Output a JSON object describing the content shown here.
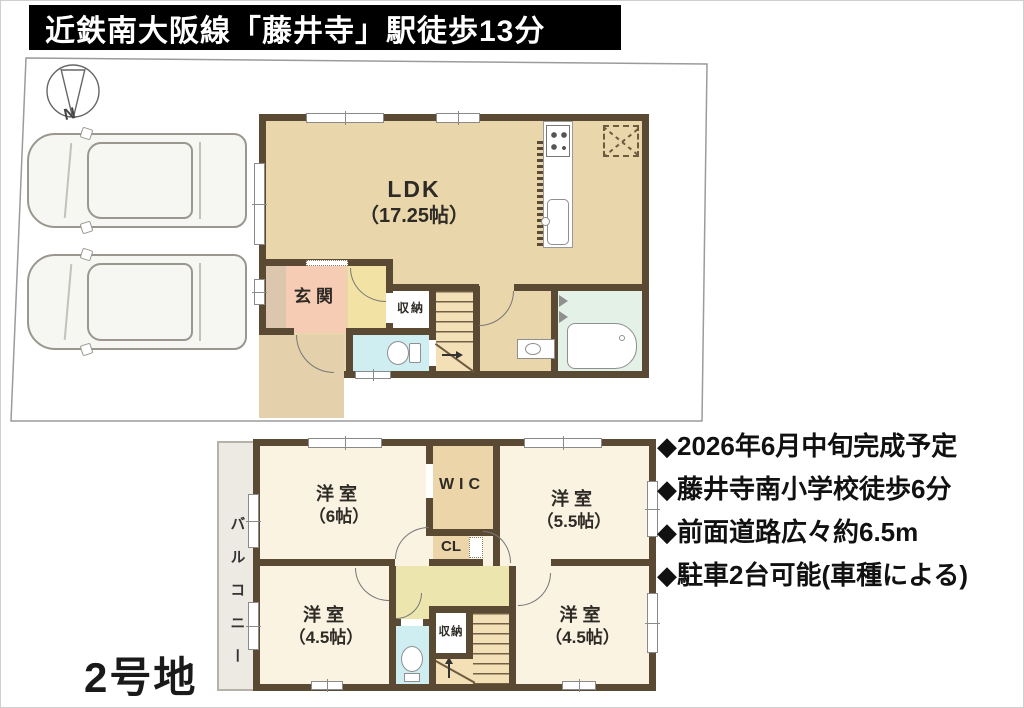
{
  "banner": {
    "title": "近鉄南大阪線「藤井寺」駅徒歩13分"
  },
  "compass": {
    "north": "N"
  },
  "lot": {
    "label": "2号地"
  },
  "features": [
    "◆2026年6月中旬完成予定",
    "◆藤井寺南小学校徒歩6分",
    "◆前面道路広々約6.5m",
    "◆駐車2台可能(車種による)"
  ],
  "floor1": {
    "ldk": {
      "name": "LDK",
      "size": "（17.25帖）"
    },
    "genkan": {
      "name": "玄関"
    },
    "storage": {
      "name": "収納"
    }
  },
  "floor2": {
    "balcony": {
      "name": "バルコニー"
    },
    "wic": {
      "name": "WIC"
    },
    "cl": {
      "name": "CL"
    },
    "storage": {
      "name": "収納"
    },
    "room_nw": {
      "name": "洋室",
      "size": "（6帖）"
    },
    "room_ne": {
      "name": "洋室",
      "size": "（5.5帖）"
    },
    "room_sw": {
      "name": "洋室",
      "size": "（4.5帖）"
    },
    "room_se": {
      "name": "洋室",
      "size": "（4.5帖）"
    }
  },
  "colors": {
    "wall": "#5b4a33",
    "floor_tan": "#ead6ab",
    "room_cream": "#faf3e2",
    "genkan_pink": "#f6cdb4",
    "hall_yellow": "#f2e3a4",
    "hall2_yellow": "#ece5ae",
    "toilet_cyan": "#cfeef2",
    "bath_green": "#e3f1e7",
    "closet_tan": "#ecd6a9",
    "stair_tan": "#f3e0b6",
    "outside_tan": "#e4d1ab"
  }
}
